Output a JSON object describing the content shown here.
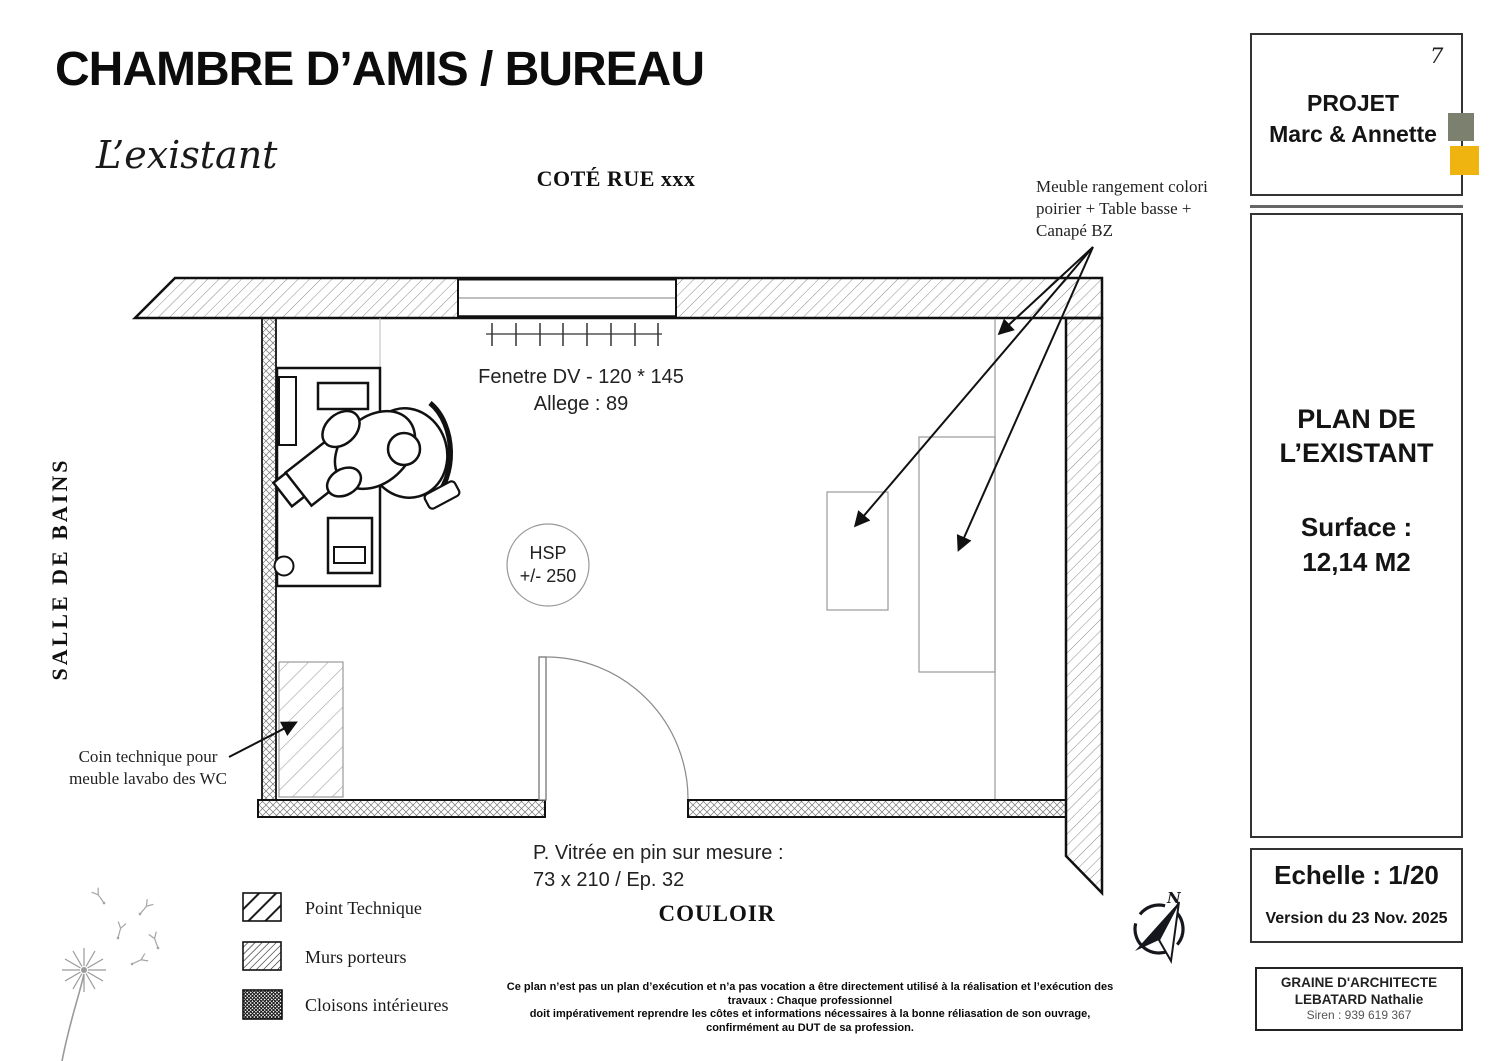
{
  "title": "CHAMBRE D’AMIS / BUREAU",
  "subtitle": "L’existant",
  "plan": {
    "cote_rue": "COTÉ RUE xxx",
    "salle_de_bains_label": "SALLE DE BAINS",
    "couloir_label": "COULOIR",
    "window": {
      "line1": "Fenetre DV - 120 * 145",
      "line2": "Allege : 89"
    },
    "hsp": {
      "line1": "HSP",
      "line2": "+/- 250"
    },
    "door": {
      "line1": "P. Vitrée en pin sur mesure :",
      "line2": "73 x 210 / Ep. 32"
    },
    "annotations": {
      "meuble": "Meuble rangement colori poirier + Table basse + Canapé BZ",
      "coin": "Coin technique pour meuble lavabo des WC"
    }
  },
  "legend": {
    "items": [
      {
        "label": "Point Technique",
        "pattern": "wide-diagonal-hatch"
      },
      {
        "label": "Murs porteurs",
        "pattern": "dense-diagonal-hatch"
      },
      {
        "label": "Cloisons intérieures",
        "pattern": "dark-crosshatch"
      }
    ]
  },
  "disclaimer": {
    "line1": "Ce plan n’est pas un plan d’exécution et n’a pas vocation a être directement utilisé à la réalisation et l’exécution des travaux : Chaque professionnel",
    "line2": "doit impérativement reprendre les côtes et informations nécessaires à la bonne réliasation de son ouvrage, confirmément au DUT de sa profession."
  },
  "title_block": {
    "page_number": "7",
    "project_label": "PROJET",
    "project_client": "Marc & Annette",
    "plan_title_line1": "PLAN DE",
    "plan_title_line2": "L’EXISTANT",
    "surface_label": "Surface :",
    "surface_value": "12,14 M2",
    "scale": "Echelle : 1/20",
    "version": "Version du 23 Nov. 2025",
    "firm_name": "GRAINE D'ARCHITECTE",
    "firm_person": "LEBATARD Nathalie",
    "firm_siren": "Siren : 939 619 367",
    "accent_gray": "#7c816f",
    "accent_yellow": "#f0b410"
  },
  "compass": {
    "north_label": "N"
  }
}
